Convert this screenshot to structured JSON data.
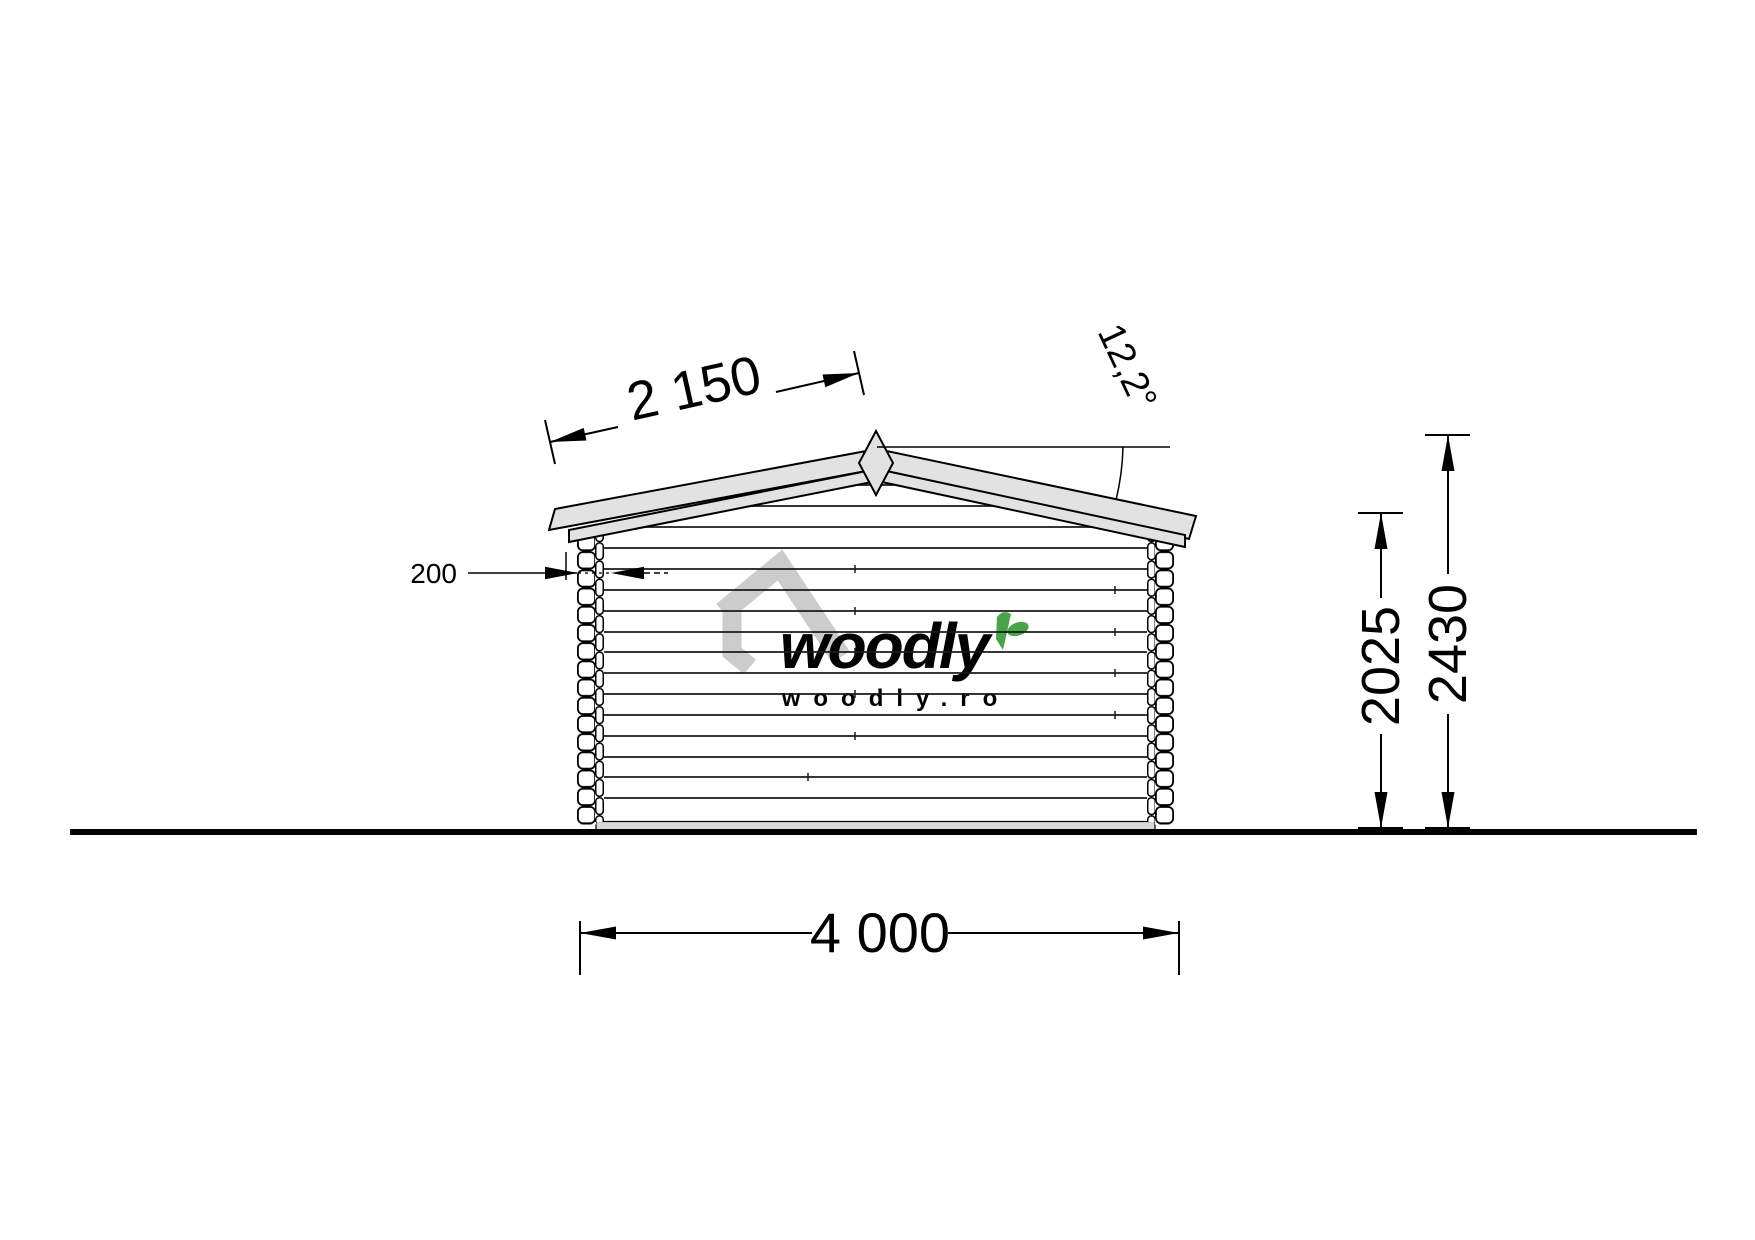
{
  "drawing": {
    "type": "log-cabin-side-elevation",
    "dimensions": {
      "roof_slope_length": "2 150",
      "roof_angle": "12,2°",
      "wall_thickness": "200",
      "wall_height": "2025",
      "total_height": "2430",
      "building_width": "4 000"
    },
    "watermark": {
      "brand": "woodly",
      "website": "woodly.ro"
    },
    "colors": {
      "line": "#000000",
      "wall_line": "#1a1a1a",
      "roof_fill": "#e2e2e2",
      "baseboard_fill": "#d9d9d9",
      "watermark_gray": "#c9c9c9",
      "watermark_green": "#46a546",
      "background": "#ffffff"
    }
  }
}
